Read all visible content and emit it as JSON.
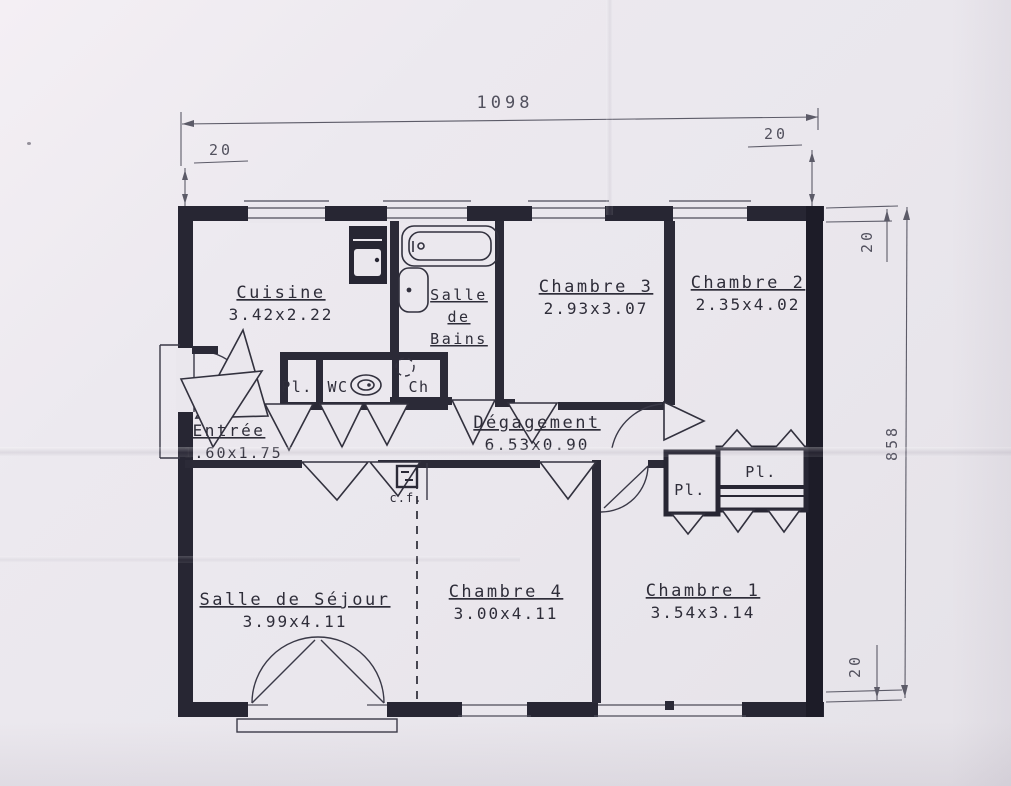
{
  "document_type": "floor-plan-scan",
  "colors": {
    "paper": "#eae7ed",
    "ink": "#272633"
  },
  "dimensions": {
    "overall_width": "1098",
    "overall_height": "858",
    "wall_offset_top_left": "20",
    "wall_offset_top_right": "20",
    "wall_offset_right_top": "20",
    "wall_offset_right_bottom": "20"
  },
  "rooms": [
    {
      "name": "Cuisine",
      "size": "3.42x2.22"
    },
    {
      "name": "Salle de Bains",
      "size": "",
      "name_lines": [
        "Salle",
        "de",
        "Bains"
      ]
    },
    {
      "name": "Chambre 3",
      "size": "2.93x3.07"
    },
    {
      "name": "Chambre 2",
      "size": "2.35x4.02"
    },
    {
      "name": "Entrée",
      "size": "1.60x1.75"
    },
    {
      "name": "Dégagement",
      "size": "6.53x0.90"
    },
    {
      "name": "Salle de Séjour",
      "size": "3.99x4.11"
    },
    {
      "name": "Chambre 4",
      "size": "3.00x4.11"
    },
    {
      "name": "Chambre 1",
      "size": "3.54x3.14"
    }
  ],
  "labels": {
    "closet_hall": "Pl.",
    "wc": "WC",
    "water_heater_closet": "Ch",
    "flue": "c.f.",
    "closet_small_right": "Pl.",
    "closet_large_right": "Pl."
  }
}
